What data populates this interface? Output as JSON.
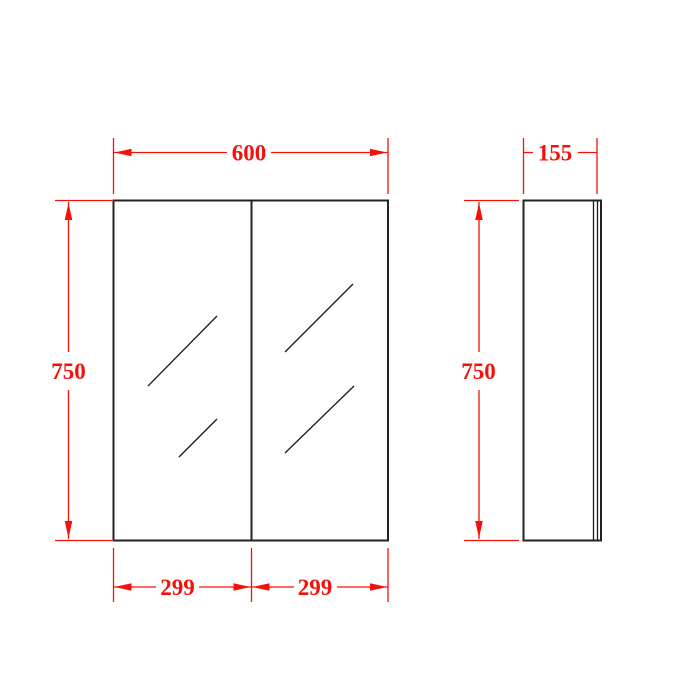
{
  "drawing": {
    "views": {
      "front": {
        "width_label": "600",
        "height_label": "750",
        "left_door_width_label": "299",
        "right_door_width_label": "299"
      },
      "side": {
        "depth_label": "155",
        "height_label": "750"
      }
    },
    "colors": {
      "dimension": "#f51109",
      "outline": "#232323",
      "background": "#ffffff"
    }
  }
}
